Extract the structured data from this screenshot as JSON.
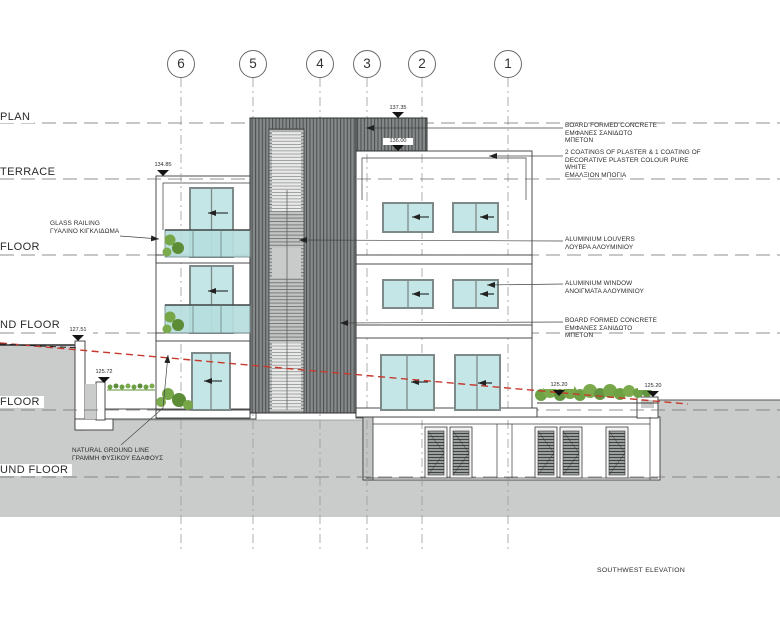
{
  "drawing_title": "SOUTHWEST ELEVATION",
  "grid_bubbles": [
    "6",
    "5",
    "4",
    "3",
    "2",
    "1"
  ],
  "levels": [
    {
      "label": "PLAN"
    },
    {
      "label": "TERRACE"
    },
    {
      "label": "FLOOR"
    },
    {
      "label": "ND FLOOR"
    },
    {
      "label": "FLOOR"
    },
    {
      "label": "UND FLOOR"
    }
  ],
  "elevation_marks": [
    "137.35",
    "136.00",
    "134.85",
    "127.51",
    "125.72",
    "125.20",
    "125.20"
  ],
  "annotations_right": [
    {
      "lines": [
        "BOARD FORMED CONCRETE",
        "ΕΜΦΑΝΕΣ ΣΑΝΙΔΩΤΟ",
        "ΜΠΕΤΟΝ"
      ]
    },
    {
      "lines": [
        "2 COATINGS OF PLASTER & 1 COATING OF",
        "DECORATIVE PLASTER COLOUR PURE",
        "WHITE",
        "ΕΜΑΛΞΙΟΝ ΜΠΟΓΙΑ"
      ]
    },
    {
      "lines": [
        "ALUMINIUM LOUVERS",
        "ΛΟΥΒΡΑ ΑΛΟΥΜΙΝΙΟΥ"
      ]
    },
    {
      "lines": [
        "ALUMINIUM WINDOW",
        "ΑΝΟΙΓΜΑΤΑ ΑΛΟΥΜΙΝΙΟΥ"
      ]
    },
    {
      "lines": [
        "BOARD FORMED CONCRETE",
        "ΕΜΦΑΝΕΣ ΣΑΝΙΔΩΤΟ",
        "ΜΠΕΤΟΝ"
      ]
    }
  ],
  "annotations_left": [
    {
      "lines": [
        "GLASS RAILING",
        "ΓΥΑΛΙΝΟ ΚΙΓΚΛΙΔΩΜΑ"
      ]
    },
    {
      "lines": [
        "NATURAL GROUND LINE",
        "ΓΡΑΜΜΗ ΦΥΣΙΚΟΥ ΕΔΑΦΟΥΣ"
      ]
    }
  ],
  "colors": {
    "earth": "#c9ccca",
    "glass": "#c4e6e6",
    "railing_glass": "#b7dede",
    "tower": "#868989",
    "tower_stripe": "#4e5152",
    "plants": "#76a648",
    "ground_line_red": "#c63a2e",
    "outline": "#3b3b3b"
  }
}
